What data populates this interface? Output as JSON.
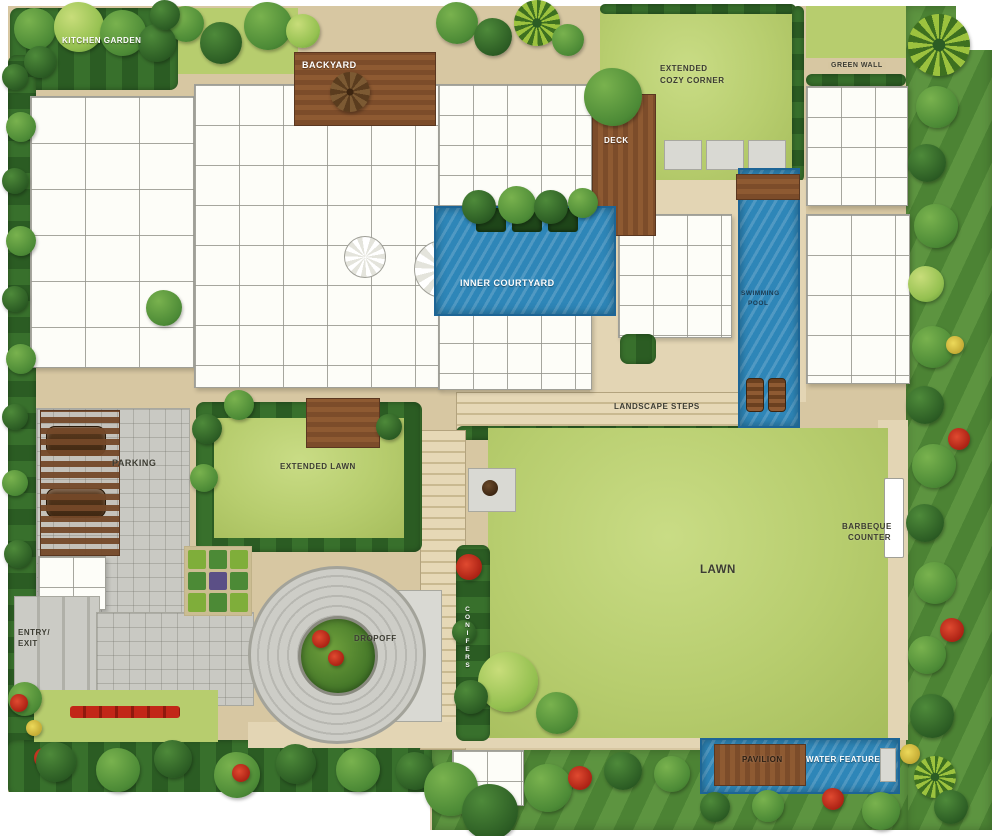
{
  "plan_type": "residential-landscape-master-plan",
  "palette": {
    "ground": "#d7c7a2",
    "path_light": "#e3d5b4",
    "paver_gray": "#c6c6c0",
    "lawn": "#b7cd6e",
    "lawn_light": "#c9dc85",
    "hedge": "#2f6428",
    "foliage": "#5d9440",
    "water": "#2e86b8",
    "water_dark": "#1d6596",
    "wood": "#7c4c2a",
    "wood_light": "#96663a",
    "building": "#fdfdf8",
    "wall": "#a8a8a0",
    "label": "#3c3c32",
    "label_light": "#ffffff",
    "flower_red": "#c22718",
    "flower_yellow": "#e3cf52"
  },
  "labels": {
    "kitchen_garden": "KITCHEN GARDEN",
    "backyard": "BACKYARD",
    "extended_cozy_corner_line1": "EXTENDED",
    "extended_cozy_corner_line2": "COZY CORNER",
    "green_wall": "GREEN WALL",
    "deck": "DECK",
    "inner_courtyard": "INNER COURTYARD",
    "swimming_pool_line1": "SWIMMING",
    "swimming_pool_line2": "POOL",
    "landscape_steps": "LANDSCAPE STEPS",
    "parking": "PARKING",
    "extended_lawn": "EXTENDED LAWN",
    "lawn": "LAWN",
    "barbeque_counter_line1": "BARBEQUE",
    "barbeque_counter_line2": "COUNTER",
    "entry_exit_line1": "ENTRY/",
    "entry_exit_line2": "EXIT",
    "dropoff": "DROPOFF",
    "hedge_strip_vertical": "CONIFERS",
    "pavilion": "PAVILION",
    "water_feature": "WATER FEATURE"
  },
  "trees": [
    {
      "x": 168,
      "y": 6,
      "s": 36,
      "v": "mid"
    },
    {
      "x": 200,
      "y": 22,
      "s": 42,
      "v": "dark"
    },
    {
      "x": 244,
      "y": 2,
      "s": 48,
      "v": "mid"
    },
    {
      "x": 286,
      "y": 14,
      "s": 34,
      "v": "light"
    },
    {
      "x": 436,
      "y": 2,
      "s": 42,
      "v": "mid"
    },
    {
      "x": 474,
      "y": 18,
      "s": 38,
      "v": "dark"
    },
    {
      "x": 514,
      "y": 0,
      "s": 46,
      "v": "palm"
    },
    {
      "x": 552,
      "y": 24,
      "s": 32,
      "v": "mid"
    },
    {
      "x": 14,
      "y": 8,
      "s": 42,
      "v": "mid"
    },
    {
      "x": 54,
      "y": 2,
      "s": 50,
      "v": "light"
    },
    {
      "x": 100,
      "y": 10,
      "s": 46,
      "v": "mid"
    },
    {
      "x": 138,
      "y": 24,
      "s": 38,
      "v": "dark"
    },
    {
      "x": 24,
      "y": 46,
      "s": 32,
      "v": "dark"
    },
    {
      "x": 150,
      "y": 0,
      "s": 30,
      "v": "dark"
    },
    {
      "x": 330,
      "y": 72,
      "s": 40,
      "v": "brown"
    },
    {
      "x": 584,
      "y": 68,
      "s": 58,
      "v": "mid"
    },
    {
      "x": 908,
      "y": 14,
      "s": 62,
      "v": "palm"
    },
    {
      "x": 916,
      "y": 86,
      "s": 42,
      "v": "mid"
    },
    {
      "x": 908,
      "y": 144,
      "s": 38,
      "v": "dark"
    },
    {
      "x": 914,
      "y": 204,
      "s": 44,
      "v": "mid"
    },
    {
      "x": 908,
      "y": 266,
      "s": 36,
      "v": "light"
    },
    {
      "x": 912,
      "y": 326,
      "s": 42,
      "v": "mid"
    },
    {
      "x": 946,
      "y": 336,
      "s": 18,
      "v": "yellow"
    },
    {
      "x": 906,
      "y": 386,
      "s": 38,
      "v": "dark"
    },
    {
      "x": 948,
      "y": 428,
      "s": 22,
      "v": "red"
    },
    {
      "x": 912,
      "y": 444,
      "s": 44,
      "v": "mid"
    },
    {
      "x": 906,
      "y": 504,
      "s": 38,
      "v": "dark"
    },
    {
      "x": 914,
      "y": 562,
      "s": 42,
      "v": "mid"
    },
    {
      "x": 940,
      "y": 618,
      "s": 24,
      "v": "red"
    },
    {
      "x": 908,
      "y": 636,
      "s": 38,
      "v": "mid"
    },
    {
      "x": 910,
      "y": 694,
      "s": 44,
      "v": "dark"
    },
    {
      "x": 900,
      "y": 744,
      "s": 20,
      "v": "yellow"
    },
    {
      "x": 914,
      "y": 756,
      "s": 42,
      "v": "palm"
    },
    {
      "x": 862,
      "y": 792,
      "s": 38,
      "v": "mid"
    },
    {
      "x": 934,
      "y": 790,
      "s": 34,
      "v": "dark"
    },
    {
      "x": 2,
      "y": 64,
      "s": 26,
      "v": "dark"
    },
    {
      "x": 6,
      "y": 112,
      "s": 30,
      "v": "mid"
    },
    {
      "x": 2,
      "y": 168,
      "s": 26,
      "v": "dark"
    },
    {
      "x": 6,
      "y": 226,
      "s": 30,
      "v": "mid"
    },
    {
      "x": 2,
      "y": 286,
      "s": 26,
      "v": "dark"
    },
    {
      "x": 6,
      "y": 344,
      "s": 30,
      "v": "mid"
    },
    {
      "x": 2,
      "y": 404,
      "s": 26,
      "v": "dark"
    },
    {
      "x": 2,
      "y": 470,
      "s": 26,
      "v": "mid"
    },
    {
      "x": 4,
      "y": 540,
      "s": 28,
      "v": "dark"
    },
    {
      "x": 8,
      "y": 682,
      "s": 34,
      "v": "mid"
    },
    {
      "x": 10,
      "y": 694,
      "s": 18,
      "v": "red"
    },
    {
      "x": 26,
      "y": 720,
      "s": 16,
      "v": "yellow"
    },
    {
      "x": 34,
      "y": 748,
      "s": 20,
      "v": "red"
    },
    {
      "x": 36,
      "y": 742,
      "s": 40,
      "v": "dark"
    },
    {
      "x": 96,
      "y": 748,
      "s": 44,
      "v": "mid"
    },
    {
      "x": 154,
      "y": 740,
      "s": 38,
      "v": "dark"
    },
    {
      "x": 214,
      "y": 752,
      "s": 46,
      "v": "mid"
    },
    {
      "x": 232,
      "y": 764,
      "s": 18,
      "v": "red"
    },
    {
      "x": 276,
      "y": 744,
      "s": 40,
      "v": "dark"
    },
    {
      "x": 336,
      "y": 748,
      "s": 44,
      "v": "mid"
    },
    {
      "x": 396,
      "y": 752,
      "s": 38,
      "v": "dark"
    },
    {
      "x": 424,
      "y": 762,
      "s": 54,
      "v": "mid"
    },
    {
      "x": 462,
      "y": 784,
      "s": 56,
      "v": "dark"
    },
    {
      "x": 524,
      "y": 764,
      "s": 48,
      "v": "mid"
    },
    {
      "x": 568,
      "y": 766,
      "s": 24,
      "v": "red"
    },
    {
      "x": 604,
      "y": 752,
      "s": 38,
      "v": "dark"
    },
    {
      "x": 654,
      "y": 756,
      "s": 36,
      "v": "mid"
    },
    {
      "x": 700,
      "y": 792,
      "s": 30,
      "v": "dark"
    },
    {
      "x": 752,
      "y": 790,
      "s": 32,
      "v": "mid"
    },
    {
      "x": 822,
      "y": 788,
      "s": 22,
      "v": "red"
    },
    {
      "x": 462,
      "y": 190,
      "s": 34,
      "v": "dark"
    },
    {
      "x": 498,
      "y": 186,
      "s": 38,
      "v": "mid"
    },
    {
      "x": 534,
      "y": 190,
      "s": 34,
      "v": "dark"
    },
    {
      "x": 568,
      "y": 188,
      "s": 30,
      "v": "mid"
    },
    {
      "x": 192,
      "y": 414,
      "s": 30,
      "v": "dark"
    },
    {
      "x": 190,
      "y": 464,
      "s": 28,
      "v": "mid"
    },
    {
      "x": 376,
      "y": 414,
      "s": 26,
      "v": "dark"
    },
    {
      "x": 224,
      "y": 390,
      "s": 30,
      "v": "mid"
    },
    {
      "x": 146,
      "y": 290,
      "s": 36,
      "v": "mid"
    },
    {
      "x": 478,
      "y": 652,
      "s": 60,
      "v": "light"
    },
    {
      "x": 536,
      "y": 692,
      "s": 42,
      "v": "mid"
    },
    {
      "x": 312,
      "y": 630,
      "s": 18,
      "v": "red"
    },
    {
      "x": 328,
      "y": 650,
      "s": 16,
      "v": "red"
    },
    {
      "x": 456,
      "y": 554,
      "s": 26,
      "v": "red"
    },
    {
      "x": 452,
      "y": 620,
      "s": 24,
      "v": "dark"
    },
    {
      "x": 454,
      "y": 680,
      "s": 34,
      "v": "dark"
    }
  ]
}
